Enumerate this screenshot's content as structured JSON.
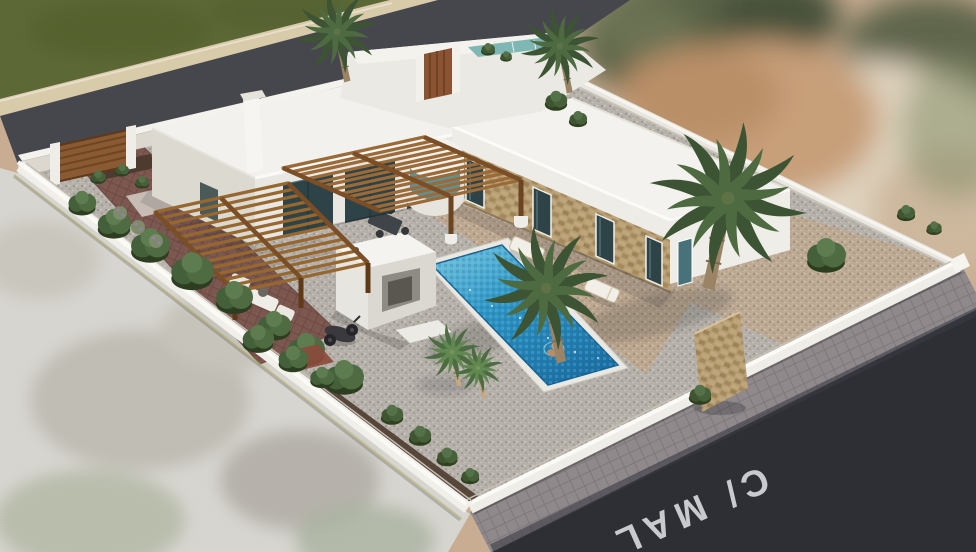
{
  "scene": {
    "type": "3d-architectural-render",
    "description": "Aerial 3D visualization of a white Ibiza-style villa on a corner plot with gravel garden, wooden pergolas, palm trees and a swimming pool",
    "street_label": "C/ MAL",
    "features": [
      "L-shaped white flat-roof villa",
      "stone-clad facade with four tall windows",
      "curved glass bay window",
      "two wooden slatted pergolas",
      "rectangular mosaic-tiled swimming pool with swimmer",
      "two sun loungers",
      "outdoor kitchen block",
      "scooter",
      "gravel garden with palm trees and shrubs",
      "red paver driveway with wooden gate",
      "white perimeter wall",
      "asphalt street with painted street name",
      "blurred aerial-photo surroundings"
    ]
  },
  "palette": {
    "roof_white": "#f3f2ee",
    "wall_white": "#eceae4",
    "wall_shade": "#dcd8d0",
    "stone_facade": "#b59c72",
    "glass_dark": "#2e4347",
    "glass_teal": "#7fb7b4",
    "wood_pergola": "#96672f",
    "wood_dark": "#6f4620",
    "pool_shallow": "#7cc9e2",
    "pool_deep": "#1b6fa3",
    "gravel_grey": "#b6b1aa",
    "gravel_warm": "#bda890",
    "paver_red": "#7c574f",
    "mulch_brown": "#4c3b2e",
    "palm_green": "#3c5434",
    "shrub_green": "#3f5531",
    "field_green": "#5c6836",
    "asphalt_rear": "#46464d",
    "asphalt_front": "#2e2f35",
    "sidewalk_grey": "#8f898c",
    "photo_tan": "#c9ad92",
    "pavement_blur": "#d7d5d0",
    "street_text": "#d2d3d7"
  }
}
